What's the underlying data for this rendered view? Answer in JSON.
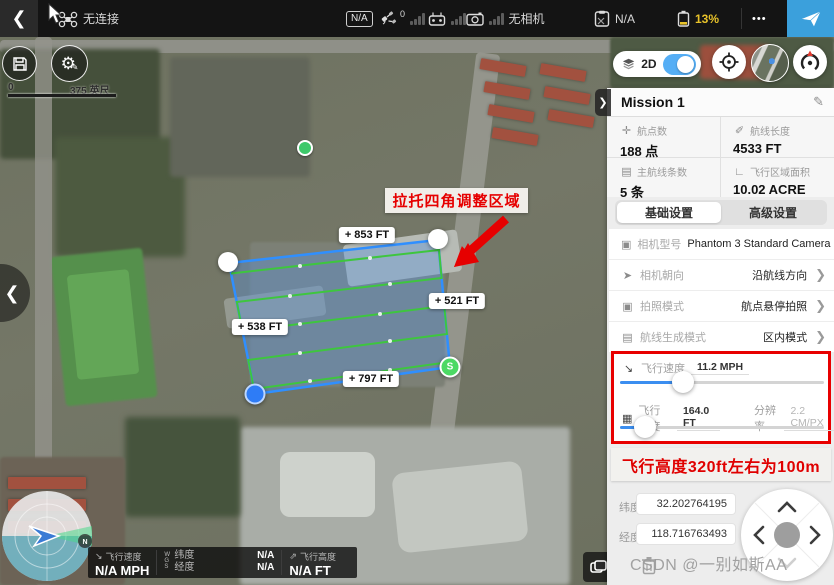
{
  "top_bar": {
    "connection_status": "无连接",
    "mode_badge": "N/A",
    "gps_count": "0",
    "camera_status": "无相机",
    "flight_mode": "N/A",
    "battery": "13%",
    "more": "•••"
  },
  "map": {
    "scale_zero": "0",
    "scale_label": "375 英尺",
    "toggle_2d": "2D",
    "annotation": "拉托四角调整区域",
    "edge_labels": {
      "top": "853 FT",
      "right": "521 FT",
      "left": "538 FT",
      "bottom": "797 FT"
    },
    "start_marker": "S",
    "compass_n": "N"
  },
  "panel": {
    "title": "Mission 1",
    "stats": [
      {
        "label": "航点数",
        "value": "188 点"
      },
      {
        "label": "航线长度",
        "value": "4533 FT"
      },
      {
        "label": "主航线条数",
        "value": "5 条"
      },
      {
        "label": "飞行区域面积",
        "value": "10.02 ACRE"
      }
    ],
    "tabs": [
      {
        "label": "基础设置"
      },
      {
        "label": "高级设置"
      }
    ],
    "settings": [
      {
        "label": "相机型号",
        "value": "Phantom 3 Standard Camera"
      },
      {
        "label": "相机朝向",
        "value": "沿航线方向"
      },
      {
        "label": "拍照模式",
        "value": "航点悬停拍照"
      },
      {
        "label": "航线生成模式",
        "value": "区内模式"
      }
    ],
    "speed": {
      "label": "飞行速度",
      "value": "11.2 MPH"
    },
    "altitude": {
      "label": "飞行高度",
      "value": "164.0 FT",
      "res_label": "分辨率",
      "res_value": "2.2 CM/PX"
    },
    "note": "飞行高度320ft左右为100m",
    "coords": {
      "lat_label": "纬度",
      "lat_value": "32.202764195",
      "lon_label": "经度",
      "lon_value": "118.716763493"
    }
  },
  "bottom_bar": {
    "speed_label": "飞行速度",
    "speed_value": "N/A MPH",
    "wgs": "WGS",
    "lat_label": "纬度",
    "lat_value": "N/A",
    "lon_label": "经度",
    "lon_value": "N/A",
    "alt_label": "飞行高度",
    "alt_value": "N/A FT"
  },
  "watermark": "CSDN @一别如斯AA",
  "colors": {
    "accent_blue": "#3BA0DC",
    "battery_yellow": "#E8C32A",
    "annotation_red": "#E60000",
    "polygon_blue": "#2F8FFF",
    "route_green": "#3EC63E"
  }
}
